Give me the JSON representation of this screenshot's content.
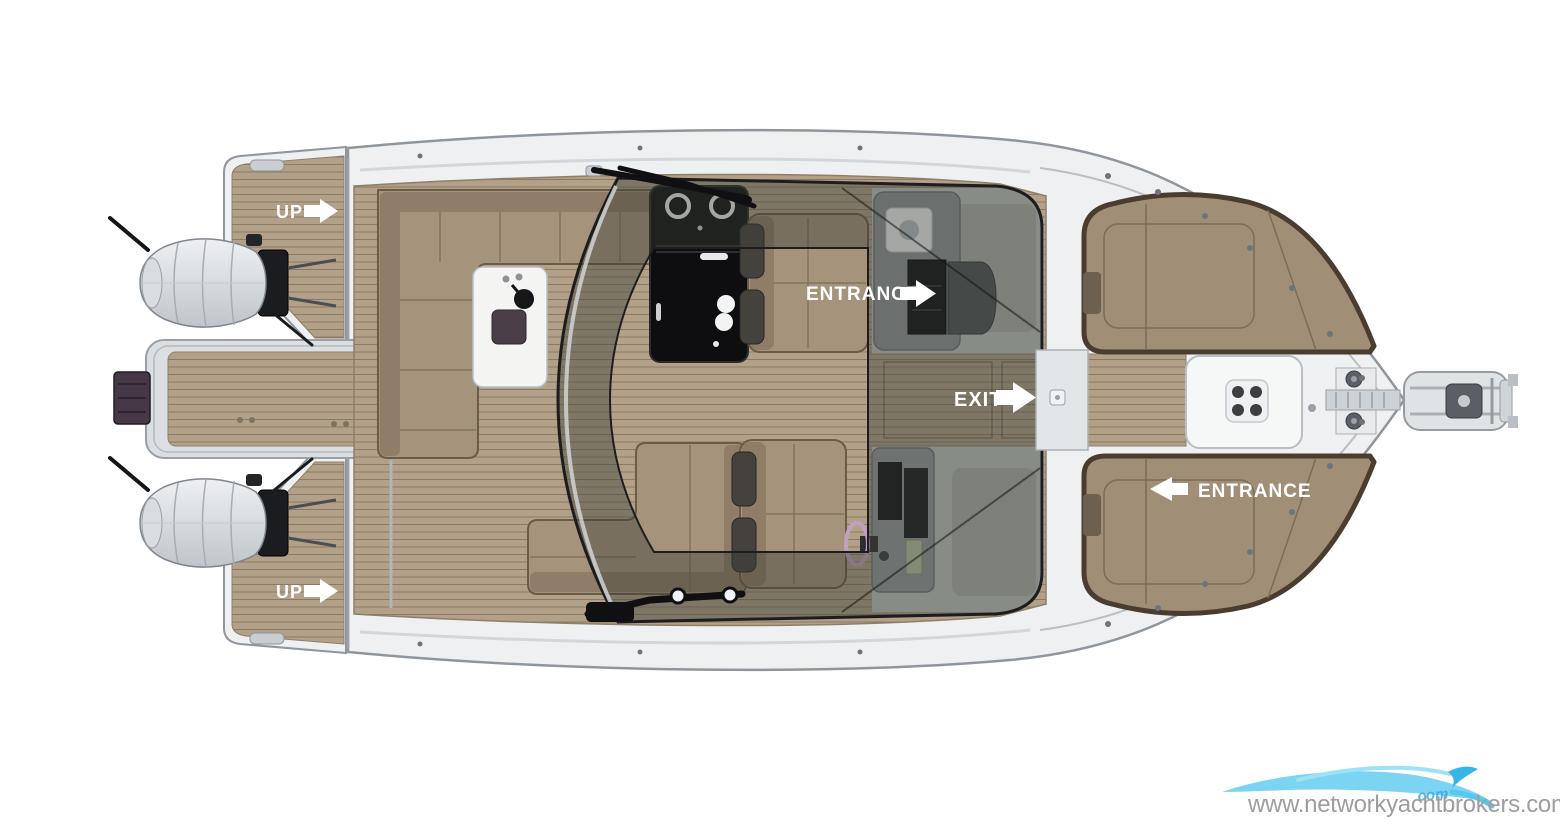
{
  "page": {
    "background": "#ffffff",
    "description": "Top-view deck plan rendering of a motor boat"
  },
  "labels": {
    "up_port": "UP",
    "up_starboard": "UP",
    "entrance_cabin": "ENTRANCE",
    "exit_cockpit": "EXIT",
    "entrance_bow": "ENTRANCE"
  },
  "watermark": {
    "url_text": "www.networkyachtbrokers.com",
    "logo_fragment_text": "com",
    "logo_icon": "wave-swoosh-icon",
    "text_color": "#9e9e9e",
    "swoosh_color": "#7ad4f2",
    "swoosh_dark_color": "#35b5e8"
  },
  "parts": [
    "swim-platform",
    "boarding-ladder",
    "twin-outboard-engines",
    "aft-sun-deck-port",
    "aft-sun-deck-starboard",
    "cockpit-l-sofa-port",
    "cockpit-sofa-starboard",
    "wet-bar",
    "outdoor-galley",
    "helm-seat-port",
    "helm-seat-starboard",
    "steering-wheel",
    "helm-console",
    "entrance-console",
    "wraparound-windshield",
    "companionway",
    "center-walkway",
    "bow-lounge-port",
    "bow-lounge-starboard",
    "bow-table-with-cupholders",
    "anchor-windlass",
    "bow-sprit-anchor-roller",
    "bimini-arm-port",
    "bimini-arm-starboard"
  ],
  "colors": {
    "hull": "#eef0f2",
    "hull_outline": "#8f969d",
    "teak": "#b2a088",
    "teak_line": "#8c7a64",
    "cushion": "#a5937c",
    "cushion_back": "#8f7d67",
    "cushion_edge": "#6b5c49",
    "galley_black": "#0e0e10",
    "glass_tint": "rgba(58,62,56,0.42)",
    "glass_frame": "#1d1d1f",
    "label_text": "#ffffff"
  }
}
